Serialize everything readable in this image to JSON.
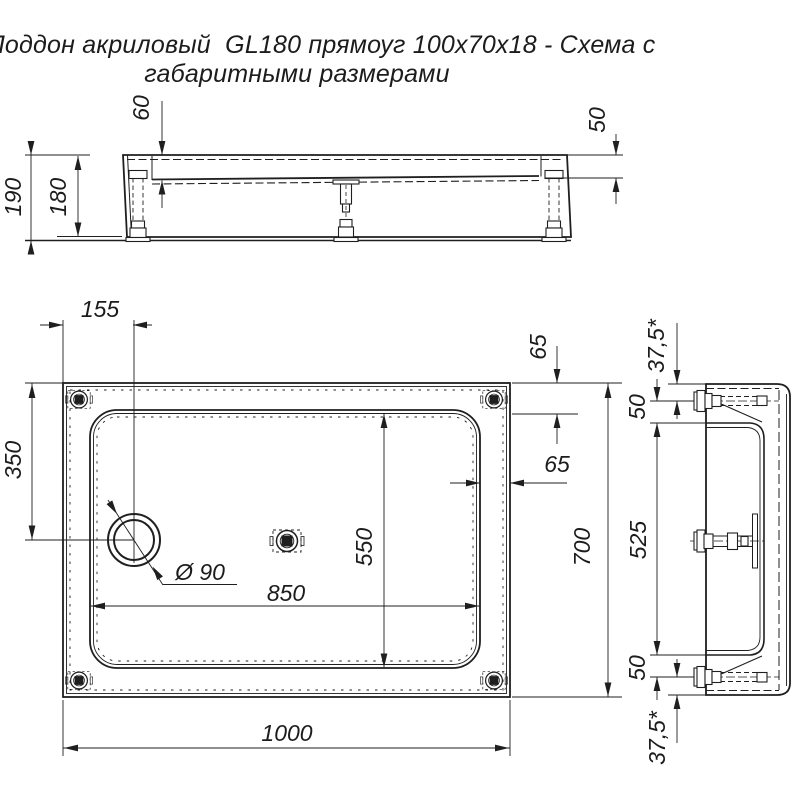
{
  "title": {
    "line1": "Поддон акриловый  GL180 прямоуг 100х70х18 - Схема с",
    "line2": "габаритными размерами"
  },
  "front_view": {
    "overall_height": "190",
    "body_height": "180",
    "depth_left": "60",
    "depth_right": "50"
  },
  "plan_view": {
    "length": "1000",
    "width": "700",
    "drain_offset_left": "155",
    "drain_offset_top": "350",
    "drain_diameter": "Ø 90",
    "basin_length": "850",
    "basin_width": "550",
    "rim_top": "65",
    "rim_side": "65"
  },
  "side_view": {
    "edge_to_leg_top": "37,5*",
    "leg_to_floor_top": "50",
    "floor_span": "525",
    "leg_to_floor_bottom": "50",
    "edge_to_leg_bottom": "37,5*"
  },
  "colors": {
    "line": "#1f1f1f",
    "background": "#ffffff"
  }
}
